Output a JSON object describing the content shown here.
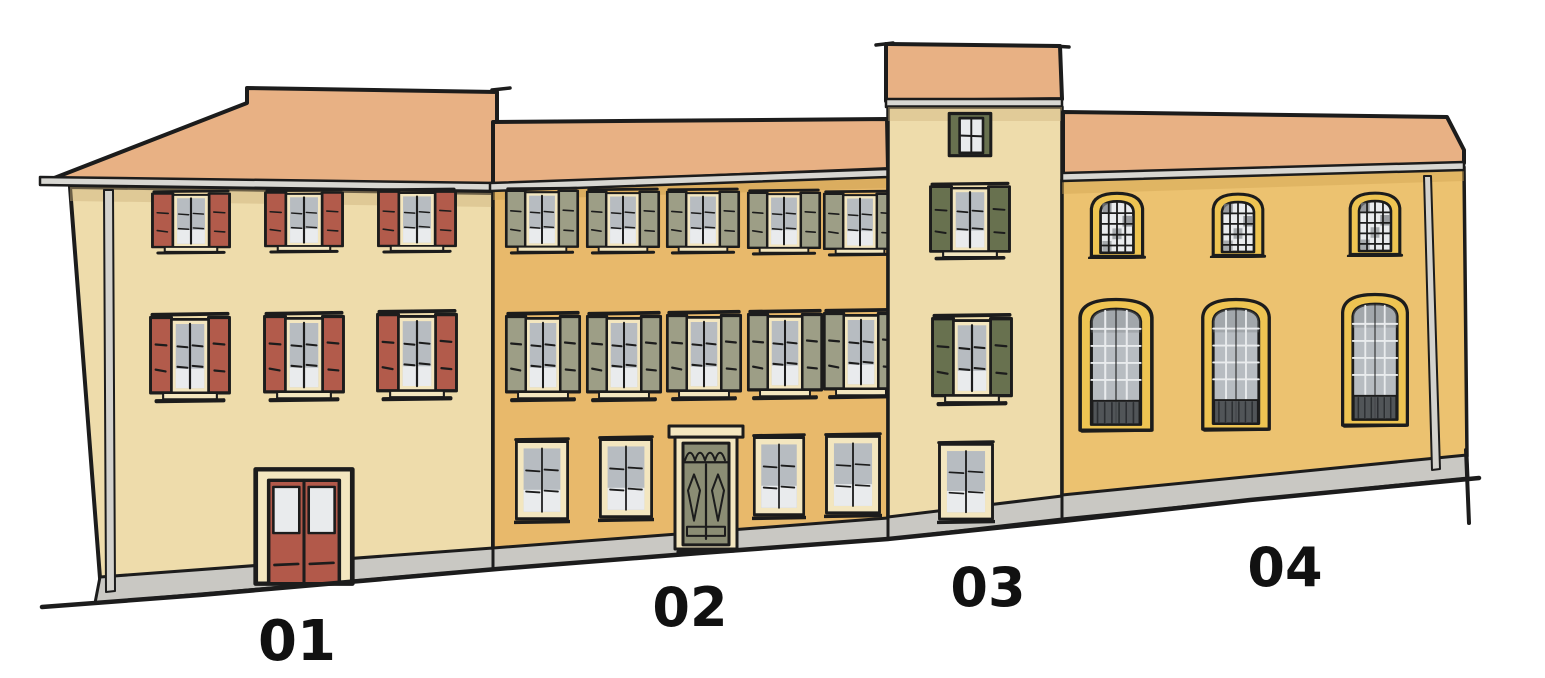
{
  "scene": {
    "kind": "hand-drawn street elevation sketch of four adjoining buildings",
    "background": "#ffffff"
  },
  "buildings": [
    {
      "id": "building-01",
      "label": "01",
      "shutters": "red",
      "upper_bays": 3,
      "upper_floors": 2,
      "ground": "red double entry door"
    },
    {
      "id": "building-02",
      "label": "02",
      "shutters": "olive",
      "upper_bays": 5,
      "upper_floors": 2,
      "ground": "four windows and central olive panel door"
    },
    {
      "id": "building-03",
      "label": "03",
      "shutters": "dark-green",
      "upper_bays": 1,
      "upper_floors": 4,
      "ground": "single window tower"
    },
    {
      "id": "building-04",
      "label": "04",
      "shutters": "none",
      "upper_bays": 3,
      "upper_floors": 2,
      "ground": "three tall arched windows with railings"
    }
  ],
  "colors": {
    "background": "#ffffff",
    "ink": "#1c1c1c",
    "roof": "#e8b184",
    "gutter": "#d8d7d2",
    "wall_cream": "#eedcab",
    "wall_cream_shadow": "#cdb27c",
    "wall_ochre": "#e8b96b",
    "wall_ochre_shadow": "#c99a4e",
    "wall_gold": "#ecc270",
    "wall_gold_shadow": "#cfa24f",
    "plinth": "#c9c8c3",
    "shutter_red": "#b25b4b",
    "shutter_olive": "#9d9e86",
    "shutter_green": "#68714f",
    "frame_cream": "#f3e6bf",
    "window_yellow": "#eec452",
    "glass": "#b7bcc1",
    "glass_light": "#e9ebed",
    "glass_dark": "#7c8084",
    "door_red": "#b2594a",
    "door_olive": "#8b8d74",
    "railing": "#46494d",
    "railing_dark": "#2b2e31",
    "pipe": "#d3d2cd",
    "label_color": "#111111"
  }
}
